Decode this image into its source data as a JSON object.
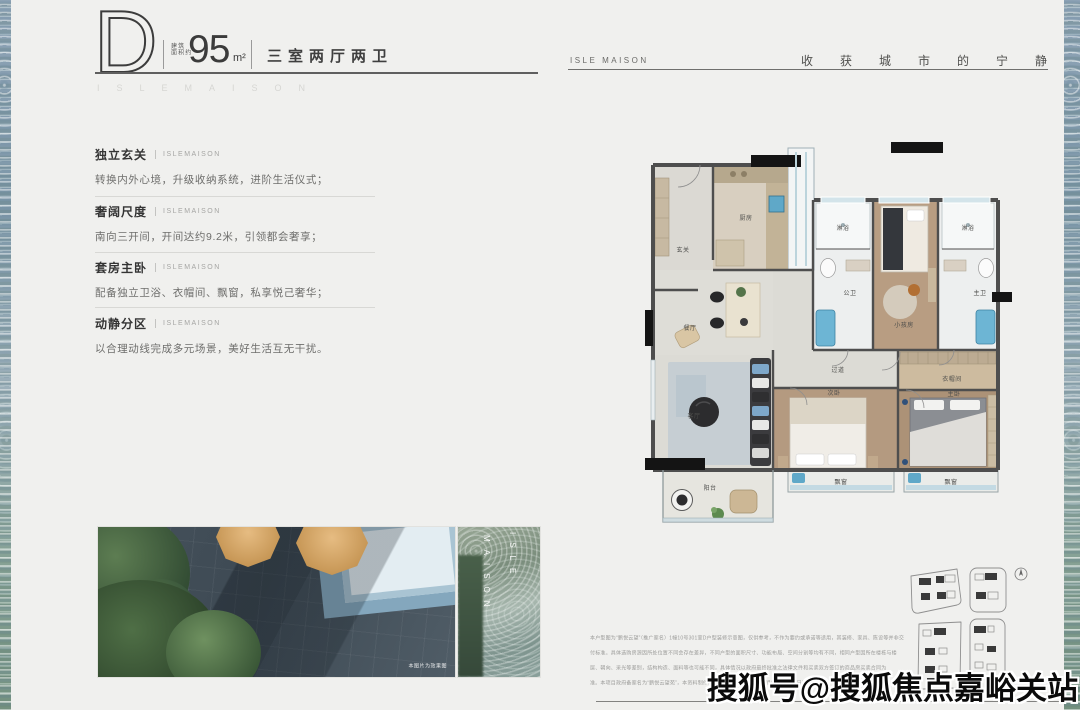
{
  "header": {
    "unit_letter": "D",
    "area_prefix_l1": "建筑",
    "area_prefix_l2": "面积约",
    "area_value": "95",
    "area_unit": "m²",
    "layout_label": "三室两厅两卫",
    "brand_ghost": "ISLEMAISON"
  },
  "right_header": {
    "brand": "ISLE MAISON",
    "slogan": "收获城市的宁静"
  },
  "features": [
    {
      "title": "独立玄关",
      "brand": "ISLEMAISON",
      "desc": "转换内外心境，升级收纳系统，进阶生活仪式；"
    },
    {
      "title": "奢阔尺度",
      "brand": "ISLEMAISON",
      "desc": "南向三开间，开间达约9.2米，引领都会奢享；"
    },
    {
      "title": "套房主卧",
      "brand": "ISLEMAISON",
      "desc": "配备独立卫浴、衣帽间、飘窗，私享悦己奢华；"
    },
    {
      "title": "动静分区",
      "brand": "ISLEMAISON",
      "desc": "以合理动线完成多元场景，美好生活互无干扰。"
    }
  ],
  "photos": {
    "caption": "本图片为效果图",
    "glass_left": "MAISON",
    "glass_right": "ISLE"
  },
  "floorplan": {
    "rooms": [
      {
        "label": "玄关"
      },
      {
        "label": "厨房"
      },
      {
        "label": "餐厅"
      },
      {
        "label": "客厅"
      },
      {
        "label": "阳台"
      },
      {
        "label": "淋浴"
      },
      {
        "label": "公卫"
      },
      {
        "label": "小孩房"
      },
      {
        "label": "淋浴"
      },
      {
        "label": "主卫"
      },
      {
        "label": "过道"
      },
      {
        "label": "衣帽间"
      },
      {
        "label": "次卧"
      },
      {
        "label": "主卧"
      },
      {
        "label": "飘窗"
      },
      {
        "label": "飘窗"
      }
    ]
  },
  "disclaimer": {
    "lines": [
      "本户型图为“鹏悦云望”（推广案名）1幢10号301室D户型装修示意图，仅供参考，不作为要约或承诺等适用，其装修、家具、陈设等并非交",
      "付标准。具体选购房源因所处位置不同会存在差异，不同户型的面积尺寸、功能布局、空间分割等均有不同，相同户型因所在楼栋与楼",
      "层、朝向、采光等差别，结构构造、面料等也可能不同，具体情况以政府最终批准之法律文件和买卖双方签订的商品房买卖合同为",
      "准。本项目政府备案名为“鹏悦云望苑”，本资料制作时间为2025年8月29日，相关变化不再另行通知。"
    ]
  },
  "watermark": {
    "text": "搜狐号@搜狐焦点嘉峪关站"
  },
  "colors": {
    "accent_blue": "#5fa8c8",
    "wood": "#b49a80",
    "wall": "#4e4e4e",
    "marble": "#dcdbd5",
    "umbrella_tan": "#d8a96f"
  }
}
